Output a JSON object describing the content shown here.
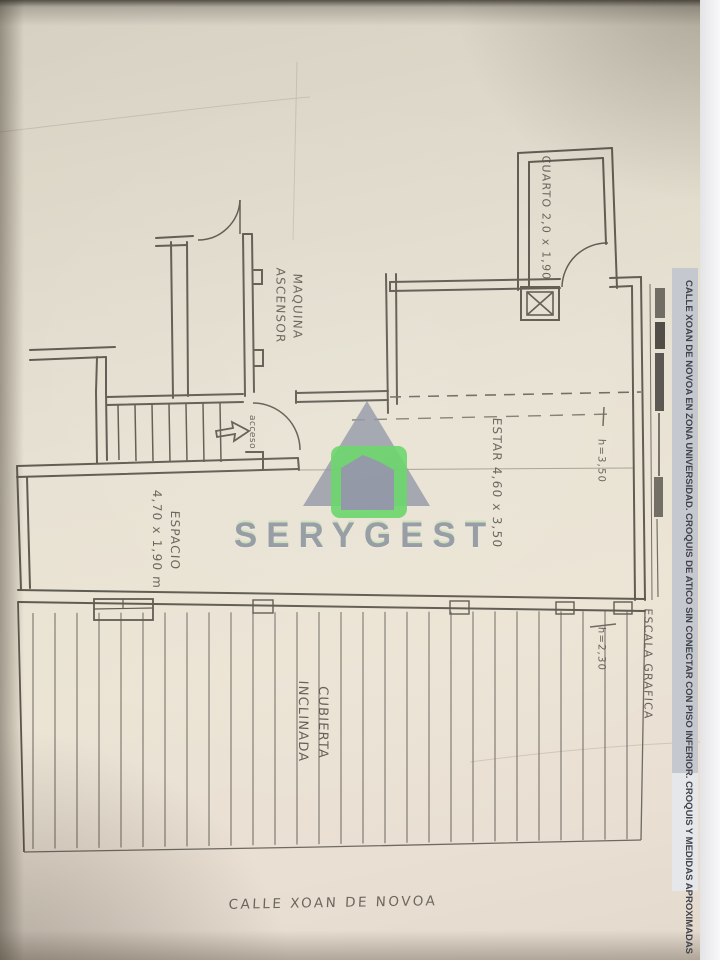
{
  "banner": {
    "text": "CALLE XOAN DE NOVOA EN ZONA UNIVERSIDAD. CROQUIS DE ATICO SIN CONECTAR CON PISO INFERIOR.  CROQUIS Y MEDIDAS APROXIMADAS"
  },
  "watermark": {
    "brand": "SERYGEST"
  },
  "labels": {
    "cuarto": "CUARTO 2,0 x 1,90",
    "maquina_1": "MAQUINA",
    "maquina_2": "ASCENSOR",
    "estar": "ESTAR 4,60 x 3,50",
    "espacio_1": "ESPACIO",
    "espacio_2": "4,70 x 1,90 m",
    "cubierta_1": "CUBIERTA",
    "cubierta_2": "INCLINADA",
    "acceso": "acceso",
    "escala": "ESCALA GRAFICA",
    "h_estar": "h=3,50",
    "h_cubierta": "h=2,30",
    "street": "CALLE XOAN DE NOVOA"
  },
  "colors": {
    "pencil": "#5b564c",
    "paper": "#e7e1d2",
    "logo_green": "#5ed35e",
    "logo_gray": "#8a90a0",
    "banner_bg": "#c5c8ce",
    "banner_text": "#3e434b",
    "brand_text": "#8d939d"
  }
}
